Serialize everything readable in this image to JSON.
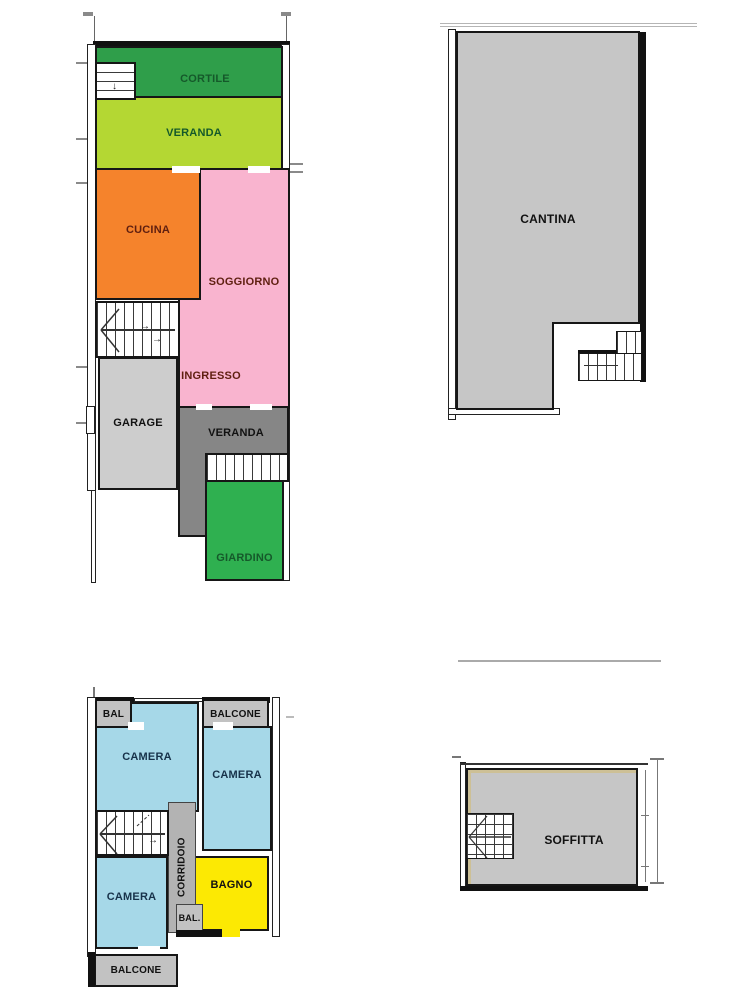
{
  "title": "Planimetria appartamento (floor plans)",
  "colors": {
    "cortile_green": "#2f9e4a",
    "veranda_lime": "#b4d733",
    "cucina_orange": "#f5832c",
    "soggiorno_pink": "#f9b4cf",
    "garage_gray": "#cdcdcd",
    "veranda_back_gray": "#868686",
    "giardino_green": "#2fb050",
    "cantina_gray": "#c6c6c6",
    "camera_blue": "#a6d8e8",
    "corridoio_gray": "#b3b3b3",
    "bagno_yellow": "#fce903",
    "balcony_gray": "#c2c2c2",
    "soffitta_gray": "#c6c6c6",
    "wall_black": "#111111"
  },
  "floors": {
    "ground": {
      "cortile": "CORTILE",
      "veranda_front": "VERANDA",
      "cucina": "CUCINA",
      "soggiorno": "SOGGIORNO",
      "ingresso": "INGRESSO",
      "garage": "GARAGE",
      "veranda_back": "VERANDA",
      "giardino": "GIARDINO"
    },
    "basement": {
      "cantina": "CANTINA"
    },
    "first": {
      "bal_left": "BAL",
      "balcone_top": "BALCONE",
      "camera_nw": "CAMERA",
      "camera_ne": "CAMERA",
      "corridoio": "CORRIDOIO",
      "camera_sw": "CAMERA",
      "bagno": "BAGNO",
      "bal_small": "BAL.",
      "balcone_bottom": "BALCONE"
    },
    "attic": {
      "soffitta": "SOFFITTA"
    }
  }
}
